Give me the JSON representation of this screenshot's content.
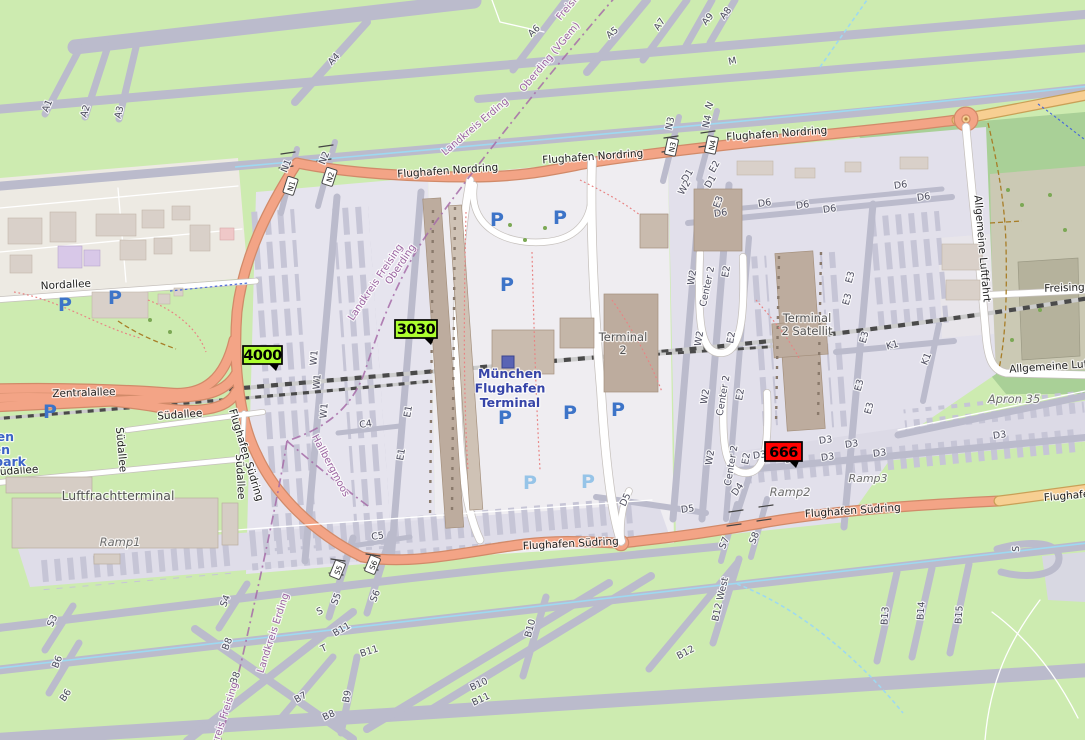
{
  "colors": {
    "grass": "#CDEBB0",
    "dark_green": "#A9D097",
    "khaki_apron": "#CBC9B4",
    "taxiway": "#BBBBCC",
    "apron_light": "#E6E4EE",
    "road_trunk_salmon": "#F3A486",
    "road_secondary_yellow": "#F7CF92",
    "railway_dash": "#4A4A4A",
    "boundary_purple": "#A66CA8",
    "taxi_centerline_blue": "#9ED9F1",
    "building": "#D9D0C9",
    "terminal_building": "#BDAC9E",
    "marker_green": "#ADFF2F",
    "marker_red": "#FF0000",
    "parking_blue": "#3D74C8",
    "station_blue": "#3644A8"
  },
  "station": {
    "name": "München Flughafen Terminal",
    "lines": [
      "München",
      "Flughafen",
      "Terminal"
    ],
    "x": 510,
    "y": 378
  },
  "markers": [
    {
      "text": "4000",
      "x": 243,
      "y": 346,
      "w": 39,
      "h": 18,
      "bg": "#ADFF2F"
    },
    {
      "text": "3030",
      "x": 395,
      "y": 320,
      "w": 42,
      "h": 18,
      "bg": "#ADFF2F"
    },
    {
      "text": "666",
      "x": 765,
      "y": 442,
      "w": 37,
      "h": 19,
      "bg": "#FF0000"
    }
  ],
  "junction_refs": [
    {
      "t": "N1",
      "x": 291,
      "y": 186,
      "r": -72
    },
    {
      "t": "N2",
      "x": 330,
      "y": 177,
      "r": -72
    },
    {
      "t": "N3",
      "x": 672,
      "y": 147,
      "r": -78
    },
    {
      "t": "N4",
      "x": 712,
      "y": 145,
      "r": -78
    },
    {
      "t": "S5",
      "x": 338,
      "y": 570,
      "r": -68
    },
    {
      "t": "S6",
      "x": 373,
      "y": 565,
      "r": -68
    }
  ],
  "parking_icons": [
    {
      "x": 65,
      "y": 311
    },
    {
      "x": 115,
      "y": 304
    },
    {
      "x": 50,
      "y": 418
    },
    {
      "x": 497,
      "y": 226
    },
    {
      "x": 560,
      "y": 224
    },
    {
      "x": 507,
      "y": 291
    },
    {
      "x": 505,
      "y": 424
    },
    {
      "x": 570,
      "y": 419
    },
    {
      "x": 618,
      "y": 416
    },
    {
      "x": 530,
      "y": 489,
      "light": true
    },
    {
      "x": 588,
      "y": 488,
      "light": true
    }
  ],
  "labels": {
    "roads": [
      {
        "t": "Flughafen Nordring",
        "x": 448,
        "y": 174,
        "r": -4
      },
      {
        "t": "Flughafen Nordring",
        "x": 593,
        "y": 160,
        "r": -4
      },
      {
        "t": "Flughafen Nordring",
        "x": 777,
        "y": 137,
        "r": -4
      },
      {
        "t": "Flughafen Südring",
        "x": 243,
        "y": 456,
        "r": 73
      },
      {
        "t": "Flughafen Südring",
        "x": 571,
        "y": 547,
        "r": -3
      },
      {
        "t": "Flughafen Südring",
        "x": 853,
        "y": 514,
        "r": -4
      },
      {
        "t": "Flughafen Südring",
        "x": 1092,
        "y": 497,
        "r": -5
      },
      {
        "t": "Zentralallee",
        "x": 84,
        "y": 396,
        "r": -2
      },
      {
        "t": "Nordallee",
        "x": 66,
        "y": 288,
        "r": -3
      },
      {
        "t": "Südallee",
        "x": 180,
        "y": 418,
        "r": -4
      },
      {
        "t": "Südallee",
        "x": 118,
        "y": 450,
        "r": 85
      },
      {
        "t": "Südallee",
        "x": 16,
        "y": 474,
        "r": -4
      },
      {
        "t": "Südallee",
        "x": 237,
        "y": 477,
        "r": 87
      },
      {
        "t": "Allgemeine Luftfahrt",
        "x": 979,
        "y": 249,
        "r": 85
      },
      {
        "t": "Allgemeine Luftfahrt",
        "x": 1063,
        "y": 369,
        "r": -4
      },
      {
        "t": "Freisinger",
        "x": 1070,
        "y": 291,
        "r": -2
      }
    ],
    "places": [
      {
        "t": "Luftfrachtterminal",
        "x": 118,
        "y": 500,
        "s": 12.5
      },
      {
        "t": "Terminal 2",
        "lines": [
          "Terminal",
          "2"
        ],
        "x": 623,
        "y": 341,
        "s": 11.5
      },
      {
        "t": "Terminal 2 Satellit",
        "lines": [
          "Terminal",
          "2 Satellit"
        ],
        "x": 807,
        "y": 322,
        "s": 11.5
      },
      {
        "t": "Ramp1",
        "x": 120,
        "y": 546,
        "s": 11.5,
        "i": 1
      },
      {
        "t": "Ramp2",
        "x": 790,
        "y": 496,
        "s": 11.5,
        "i": 1
      },
      {
        "t": "Ramp3",
        "x": 868,
        "y": 482,
        "s": 11,
        "i": 1
      },
      {
        "t": "Apron 35",
        "x": 1014,
        "y": 403,
        "s": 11.5,
        "i": 1
      },
      {
        "t": "fen",
        "x": 14,
        "y": 441,
        "s": 12.5,
        "c": "bp",
        "a": "end"
      },
      {
        "t": "en",
        "x": 10,
        "y": 454,
        "s": 12.5,
        "c": "bp",
        "a": "end"
      },
      {
        "t": "park",
        "x": 26,
        "y": 466,
        "s": 12.5,
        "c": "bp",
        "a": "end"
      }
    ],
    "boundaries": [
      {
        "t": "Freising",
        "x": 573,
        "y": 6,
        "r": -50
      },
      {
        "t": "Oberding (VGem)",
        "x": 552,
        "y": 59,
        "r": -50
      },
      {
        "t": "Landkreis Erding",
        "x": 477,
        "y": 129,
        "r": -40
      },
      {
        "t": "Landkreis Freising",
        "x": 378,
        "y": 284,
        "r": -56
      },
      {
        "t": "Oberding",
        "x": 403,
        "y": 266,
        "r": -56
      },
      {
        "t": "Hallbergmoos",
        "x": 328,
        "y": 467,
        "r": 62
      },
      {
        "t": "Landkreis Erding",
        "x": 276,
        "y": 634,
        "r": -72
      },
      {
        "t": "Landkreis Freising",
        "x": 224,
        "y": 726,
        "r": -72
      }
    ],
    "taxiways": [
      {
        "t": "A1",
        "x": 50,
        "y": 107,
        "r": -68
      },
      {
        "t": "A2",
        "x": 88,
        "y": 112,
        "r": -72
      },
      {
        "t": "A3",
        "x": 122,
        "y": 113,
        "r": -75
      },
      {
        "t": "A4",
        "x": 336,
        "y": 61,
        "r": -47
      },
      {
        "t": "A6",
        "x": 536,
        "y": 33,
        "r": -42
      },
      {
        "t": "A5",
        "x": 614,
        "y": 35,
        "r": -38
      },
      {
        "t": "A7",
        "x": 662,
        "y": 26,
        "r": -55
      },
      {
        "t": "A9",
        "x": 710,
        "y": 21,
        "r": -50
      },
      {
        "t": "A8",
        "x": 728,
        "y": 15,
        "r": -52
      },
      {
        "t": "M",
        "x": 733,
        "y": 64,
        "r": -12
      },
      {
        "t": "N",
        "x": 712,
        "y": 107,
        "r": -62
      },
      {
        "t": "N3",
        "x": 673,
        "y": 124,
        "r": -78
      },
      {
        "t": "N4",
        "x": 710,
        "y": 122,
        "r": -78
      },
      {
        "t": "N1",
        "x": 289,
        "y": 167,
        "r": -68
      },
      {
        "t": "N2",
        "x": 327,
        "y": 159,
        "r": -68
      },
      {
        "t": "E2",
        "x": 717,
        "y": 168,
        "r": -60
      },
      {
        "t": "D1",
        "x": 690,
        "y": 177,
        "r": -60
      },
      {
        "t": "D1",
        "x": 713,
        "y": 183,
        "r": -60
      },
      {
        "t": "W2",
        "x": 687,
        "y": 189,
        "r": -60
      },
      {
        "t": "E3",
        "x": 721,
        "y": 203,
        "r": -70
      },
      {
        "t": "D6",
        "x": 721,
        "y": 216,
        "r": -8
      },
      {
        "t": "D6",
        "x": 765,
        "y": 206,
        "r": -8
      },
      {
        "t": "D6",
        "x": 803,
        "y": 208,
        "r": -8
      },
      {
        "t": "D6",
        "x": 830,
        "y": 212,
        "r": -8
      },
      {
        "t": "D6",
        "x": 901,
        "y": 188,
        "r": -8
      },
      {
        "t": "D6",
        "x": 924,
        "y": 200,
        "r": -8
      },
      {
        "t": "W2",
        "x": 695,
        "y": 278,
        "r": -80
      },
      {
        "t": "W2",
        "x": 702,
        "y": 339,
        "r": -80
      },
      {
        "t": "W2",
        "x": 708,
        "y": 397,
        "r": -80
      },
      {
        "t": "W2",
        "x": 713,
        "y": 458,
        "r": -80
      },
      {
        "t": "Center 2",
        "x": 710,
        "y": 287,
        "r": -78
      },
      {
        "t": "Center 2",
        "x": 726,
        "y": 396,
        "r": -80
      },
      {
        "t": "Center 2",
        "x": 734,
        "y": 466,
        "r": -80
      },
      {
        "t": "E2",
        "x": 729,
        "y": 272,
        "r": -80
      },
      {
        "t": "E2",
        "x": 734,
        "y": 338,
        "r": -80
      },
      {
        "t": "E2",
        "x": 743,
        "y": 395,
        "r": -80
      },
      {
        "t": "E2",
        "x": 749,
        "y": 459,
        "r": -80
      },
      {
        "t": "E3",
        "x": 853,
        "y": 278,
        "r": -75
      },
      {
        "t": "E3",
        "x": 850,
        "y": 300,
        "r": -75
      },
      {
        "t": "E3",
        "x": 867,
        "y": 338,
        "r": -75
      },
      {
        "t": "E3",
        "x": 862,
        "y": 386,
        "r": -75
      },
      {
        "t": "E3",
        "x": 872,
        "y": 409,
        "r": -75
      },
      {
        "t": "K1",
        "x": 893,
        "y": 348,
        "r": -15
      },
      {
        "t": "K1",
        "x": 929,
        "y": 360,
        "r": -68
      },
      {
        "t": "W1",
        "x": 317,
        "y": 358,
        "r": -85
      },
      {
        "t": "W1",
        "x": 320,
        "y": 382,
        "r": -85
      },
      {
        "t": "W1",
        "x": 327,
        "y": 411,
        "r": -85
      },
      {
        "t": "E1",
        "x": 411,
        "y": 412,
        "r": -80
      },
      {
        "t": "E1",
        "x": 404,
        "y": 455,
        "r": -80
      },
      {
        "t": "C4",
        "x": 366,
        "y": 427,
        "r": -8
      },
      {
        "t": "C5",
        "x": 378,
        "y": 539,
        "r": -8
      },
      {
        "t": "D5",
        "x": 628,
        "y": 501,
        "r": -65
      },
      {
        "t": "D5",
        "x": 688,
        "y": 512,
        "r": -8
      },
      {
        "t": "D4",
        "x": 740,
        "y": 491,
        "r": -55
      },
      {
        "t": "D3",
        "x": 760,
        "y": 458,
        "r": -8
      },
      {
        "t": "D3",
        "x": 792,
        "y": 462,
        "r": -8
      },
      {
        "t": "D3",
        "x": 828,
        "y": 460,
        "r": -8
      },
      {
        "t": "D3",
        "x": 826,
        "y": 443,
        "r": -8
      },
      {
        "t": "D3",
        "x": 852,
        "y": 447,
        "r": -8
      },
      {
        "t": "D3",
        "x": 880,
        "y": 456,
        "r": -8
      },
      {
        "t": "D3",
        "x": 1000,
        "y": 438,
        "r": -8
      },
      {
        "t": "S7",
        "x": 727,
        "y": 544,
        "r": -68
      },
      {
        "t": "S8",
        "x": 757,
        "y": 539,
        "r": -68
      },
      {
        "t": "S",
        "x": 1019,
        "y": 549,
        "r": -88
      },
      {
        "t": "S3",
        "x": 55,
        "y": 622,
        "r": -65
      },
      {
        "t": "S4",
        "x": 228,
        "y": 602,
        "r": -68
      },
      {
        "t": "S5",
        "x": 339,
        "y": 600,
        "r": -68
      },
      {
        "t": "S6",
        "x": 378,
        "y": 597,
        "r": -68
      },
      {
        "t": "S",
        "x": 321,
        "y": 614,
        "r": -25
      },
      {
        "t": "T",
        "x": 325,
        "y": 651,
        "r": -25
      },
      {
        "t": "B6",
        "x": 60,
        "y": 663,
        "r": -68
      },
      {
        "t": "B6",
        "x": 68,
        "y": 697,
        "r": -55
      },
      {
        "t": "B7",
        "x": 302,
        "y": 700,
        "r": -30
      },
      {
        "t": "B8",
        "x": 230,
        "y": 645,
        "r": -68
      },
      {
        "t": "B8",
        "x": 238,
        "y": 679,
        "r": -68
      },
      {
        "t": "B8",
        "x": 330,
        "y": 718,
        "r": -25
      },
      {
        "t": "B9",
        "x": 350,
        "y": 697,
        "r": -80
      },
      {
        "t": "B10",
        "x": 533,
        "y": 629,
        "r": -75
      },
      {
        "t": "B10",
        "x": 480,
        "y": 687,
        "r": -25
      },
      {
        "t": "B11",
        "x": 343,
        "y": 632,
        "r": -30
      },
      {
        "t": "B11",
        "x": 370,
        "y": 654,
        "r": -18
      },
      {
        "t": "B11",
        "x": 482,
        "y": 702,
        "r": -25
      },
      {
        "t": "B12",
        "x": 687,
        "y": 655,
        "r": -28
      },
      {
        "t": "B12 West",
        "x": 723,
        "y": 600,
        "r": -77
      },
      {
        "t": "B13",
        "x": 888,
        "y": 616,
        "r": -86
      },
      {
        "t": "B14",
        "x": 924,
        "y": 611,
        "r": -86
      },
      {
        "t": "B15",
        "x": 962,
        "y": 615,
        "r": -86
      }
    ]
  }
}
